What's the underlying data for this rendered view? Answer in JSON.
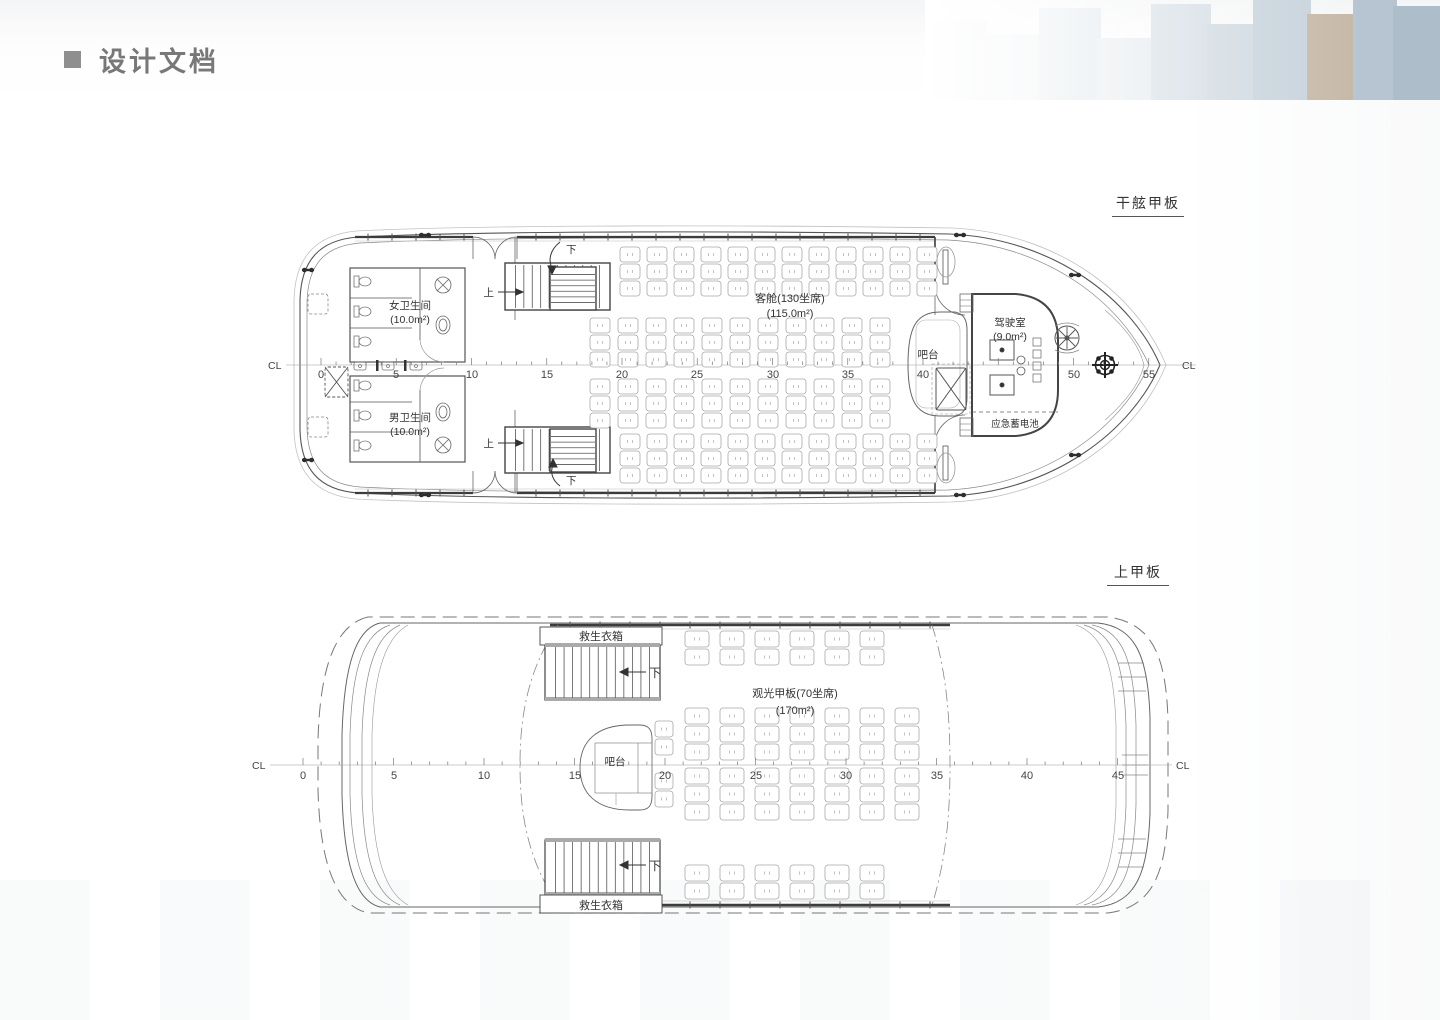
{
  "header": {
    "title": "设计文档"
  },
  "freeboard": {
    "title": "干舷甲板",
    "cl": "CL",
    "ruler": [
      "0",
      "5",
      "10",
      "15",
      "20",
      "25",
      "30",
      "35",
      "40",
      "50",
      "55"
    ],
    "cabin": "客舱(130坐席)",
    "cabin_area": "(115.0m²)",
    "women_wc": "女卫生间",
    "women_wc_area": "(10.0m²)",
    "men_wc": "男卫生间",
    "men_wc_area": "(10.0m²)",
    "bar": "吧台",
    "wheelhouse": "驾驶室",
    "wheelhouse_area": "(9.0m²)",
    "battery": "应急蓄电池",
    "up": "上",
    "down": "下"
  },
  "upper": {
    "title": "上甲板",
    "cl": "CL",
    "ruler": [
      "0",
      "5",
      "10",
      "15",
      "20",
      "25",
      "30",
      "35",
      "40",
      "45"
    ],
    "deck": "观光甲板(70坐席)",
    "deck_area": "(170m²)",
    "bar": "吧台",
    "lifejacket": "救生衣箱",
    "down": "下"
  }
}
